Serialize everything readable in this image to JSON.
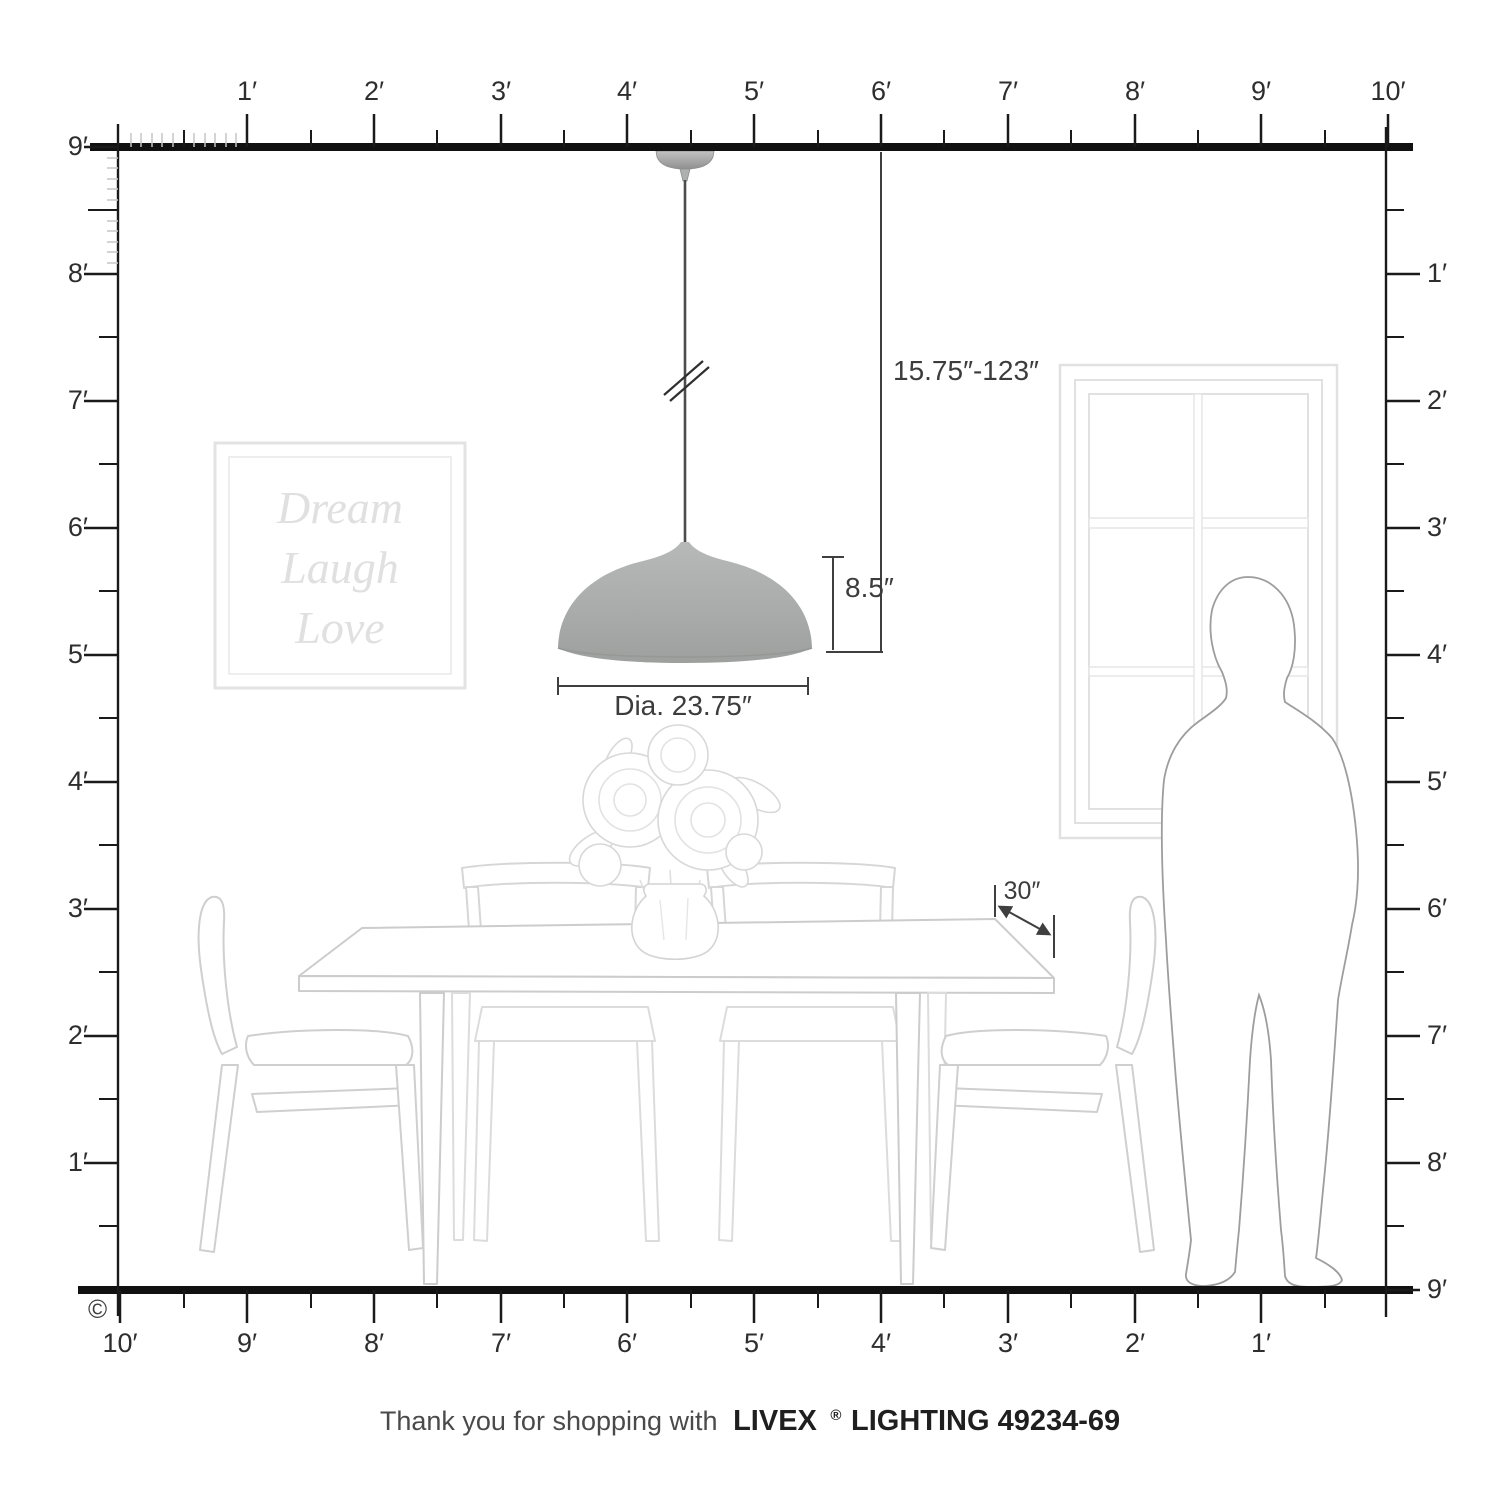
{
  "rulers": {
    "top": {
      "labels": [
        "1′",
        "2′",
        "3′",
        "4′",
        "5′",
        "6′",
        "7′",
        "8′",
        "9′",
        "10′"
      ]
    },
    "left": {
      "labels": [
        "9′",
        "8′",
        "7′",
        "6′",
        "5′",
        "4′",
        "3′",
        "2′",
        "1′"
      ]
    },
    "right": {
      "labels": [
        "1′",
        "2′",
        "3′",
        "4′",
        "5′",
        "6′",
        "7′",
        "8′",
        "9′"
      ]
    },
    "bottom": {
      "labels": [
        "10′",
        "9′",
        "8′",
        "7′",
        "6′",
        "5′",
        "4′",
        "3′",
        "2′",
        "1′"
      ]
    }
  },
  "dimensions": {
    "hang_range": "15.75″-123″",
    "shade_height": "8.5″",
    "shade_diameter": "Dia. 23.75″",
    "table_depth": "30″"
  },
  "wall_art": {
    "line1": "Dream",
    "line2": "Laugh",
    "line3": "Love"
  },
  "copyright_symbol": "©",
  "footer": {
    "thanks": "Thank you for shopping with",
    "brand": "LIVEX",
    "registered": "®",
    "product": "LIGHTING 49234-69"
  },
  "colors": {
    "ruler_line": "#1a1a1a",
    "dimension_line": "#3f3f3f",
    "shade_gray": "#a9abaa",
    "furniture_line": "#cfcfcf",
    "faint_line": "#e2e2e2"
  }
}
